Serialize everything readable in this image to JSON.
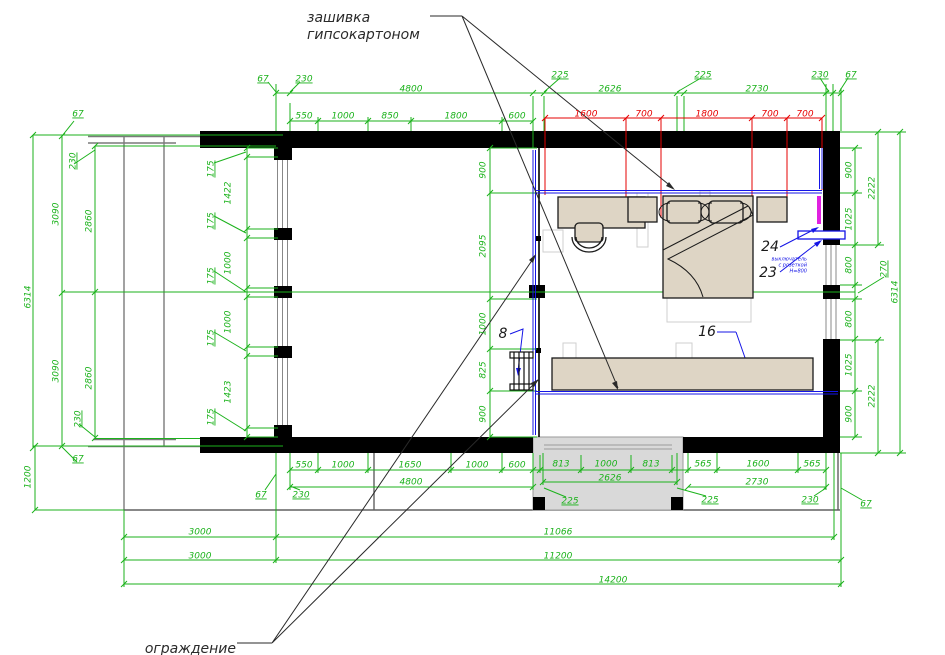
{
  "drawing": {
    "type": "floor-plan",
    "colors": {
      "dimension_green": "#1bb21b",
      "dimension_red": "#e60000",
      "annotation_blue": "#1414e6",
      "heater_magenta": "#e020e0",
      "wall_black": "#000000",
      "furniture_beige": "#ded5c5",
      "terrace_grey": "#d9d9d9"
    }
  },
  "texts": {
    "annotations": [
      {
        "t": "зашивка",
        "x": 307,
        "y": 18,
        "cls": "note"
      },
      {
        "t": "гипсокартоном",
        "x": 307,
        "y": 35,
        "cls": "note"
      },
      {
        "t": "ограждение",
        "x": 236,
        "y": 649,
        "cls": "note-end"
      },
      {
        "t": "выключатель",
        "x": 807,
        "y": 259,
        "cls": "bnote"
      },
      {
        "t": "с розеткой",
        "x": 807,
        "y": 265,
        "cls": "bnote"
      },
      {
        "t": "Н=800",
        "x": 807,
        "y": 271,
        "cls": "bnote"
      }
    ],
    "items": [
      {
        "t": "24",
        "x": 770,
        "y": 247
      },
      {
        "t": "23",
        "x": 768,
        "y": 273
      },
      {
        "t": "16",
        "x": 707,
        "y": 332
      },
      {
        "t": "8",
        "x": 503,
        "y": 334
      }
    ],
    "red": [
      {
        "t": "1600",
        "x": 586,
        "y": 114
      },
      {
        "t": "700",
        "x": 644,
        "y": 114
      },
      {
        "t": "1800",
        "x": 707,
        "y": 114
      },
      {
        "t": "700",
        "x": 770,
        "y": 114
      },
      {
        "t": "700",
        "x": 805,
        "y": 114
      }
    ],
    "green": [
      {
        "t": "67",
        "x": 263,
        "y": 79,
        "ul": 1
      },
      {
        "t": "230",
        "x": 304,
        "y": 79,
        "ul": 1
      },
      {
        "t": "4800",
        "x": 411,
        "y": 89
      },
      {
        "t": "550",
        "x": 304,
        "y": 116
      },
      {
        "t": "1000",
        "x": 343,
        "y": 116
      },
      {
        "t": "850",
        "x": 390,
        "y": 116
      },
      {
        "t": "1800",
        "x": 456,
        "y": 116
      },
      {
        "t": "600",
        "x": 517,
        "y": 116
      },
      {
        "t": "225",
        "x": 560,
        "y": 75,
        "ul": 1
      },
      {
        "t": "2626",
        "x": 610,
        "y": 89
      },
      {
        "t": "225",
        "x": 703,
        "y": 75,
        "ul": 1
      },
      {
        "t": "2730",
        "x": 757,
        "y": 89
      },
      {
        "t": "230",
        "x": 820,
        "y": 75,
        "ul": 1
      },
      {
        "t": "67",
        "x": 851,
        "y": 75,
        "ul": 1
      },
      {
        "t": "67",
        "x": 78,
        "y": 114,
        "ul": 1
      },
      {
        "t": "230",
        "x": 73,
        "y": 161,
        "r": -90,
        "ul": 1
      },
      {
        "t": "3090",
        "x": 56,
        "y": 214,
        "r": -90
      },
      {
        "t": "2860",
        "x": 89,
        "y": 221,
        "r": -90
      },
      {
        "t": "6314",
        "x": 28,
        "y": 297,
        "r": -90
      },
      {
        "t": "3090",
        "x": 56,
        "y": 371,
        "r": -90
      },
      {
        "t": "2860",
        "x": 89,
        "y": 378,
        "r": -90
      },
      {
        "t": "230",
        "x": 78,
        "y": 419,
        "r": -90,
        "ul": 1
      },
      {
        "t": "67",
        "x": 78,
        "y": 459,
        "ul": 1
      },
      {
        "t": "1200",
        "x": 28,
        "y": 477,
        "r": -90
      },
      {
        "t": "175",
        "x": 211,
        "y": 169,
        "r": -90,
        "ul": 1
      },
      {
        "t": "1422",
        "x": 228,
        "y": 193,
        "r": -90
      },
      {
        "t": "175",
        "x": 211,
        "y": 221,
        "r": -90,
        "ul": 1
      },
      {
        "t": "1000",
        "x": 228,
        "y": 263,
        "r": -90
      },
      {
        "t": "175",
        "x": 211,
        "y": 276,
        "r": -90,
        "ul": 1
      },
      {
        "t": "1000",
        "x": 228,
        "y": 322,
        "r": -90
      },
      {
        "t": "175",
        "x": 211,
        "y": 338,
        "r": -90,
        "ul": 1
      },
      {
        "t": "1423",
        "x": 228,
        "y": 392,
        "r": -90
      },
      {
        "t": "175",
        "x": 211,
        "y": 417,
        "r": -90,
        "ul": 1
      },
      {
        "t": "900",
        "x": 483,
        "y": 170,
        "r": -90
      },
      {
        "t": "2095",
        "x": 483,
        "y": 246,
        "r": -90
      },
      {
        "t": "1000",
        "x": 483,
        "y": 324,
        "r": -90
      },
      {
        "t": "825",
        "x": 483,
        "y": 370,
        "r": -90
      },
      {
        "t": "900",
        "x": 483,
        "y": 414,
        "r": -90
      },
      {
        "t": "900",
        "x": 849,
        "y": 170,
        "r": -90
      },
      {
        "t": "1025",
        "x": 849,
        "y": 219,
        "r": -90
      },
      {
        "t": "800",
        "x": 849,
        "y": 265,
        "r": -90
      },
      {
        "t": "270",
        "x": 884,
        "y": 269,
        "r": -90,
        "ul": 1
      },
      {
        "t": "800",
        "x": 849,
        "y": 319,
        "r": -90
      },
      {
        "t": "1025",
        "x": 849,
        "y": 365,
        "r": -90
      },
      {
        "t": "900",
        "x": 849,
        "y": 414,
        "r": -90
      },
      {
        "t": "2222",
        "x": 872,
        "y": 188,
        "r": -90
      },
      {
        "t": "2222",
        "x": 872,
        "y": 396,
        "r": -90
      },
      {
        "t": "6314",
        "x": 895,
        "y": 292,
        "r": -90
      },
      {
        "t": "550",
        "x": 304,
        "y": 465
      },
      {
        "t": "1000",
        "x": 343,
        "y": 465
      },
      {
        "t": "1650",
        "x": 410,
        "y": 465
      },
      {
        "t": "1000",
        "x": 477,
        "y": 465
      },
      {
        "t": "600",
        "x": 517,
        "y": 465
      },
      {
        "t": "813",
        "x": 561,
        "y": 464
      },
      {
        "t": "1000",
        "x": 606,
        "y": 464
      },
      {
        "t": "813",
        "x": 651,
        "y": 464
      },
      {
        "t": "565",
        "x": 703,
        "y": 464
      },
      {
        "t": "1600",
        "x": 758,
        "y": 464
      },
      {
        "t": "565",
        "x": 812,
        "y": 464
      },
      {
        "t": "4800",
        "x": 411,
        "y": 482
      },
      {
        "t": "2626",
        "x": 610,
        "y": 478
      },
      {
        "t": "2730",
        "x": 757,
        "y": 482
      },
      {
        "t": "67",
        "x": 261,
        "y": 495,
        "ul": 1
      },
      {
        "t": "230",
        "x": 301,
        "y": 495,
        "ul": 1
      },
      {
        "t": "225",
        "x": 570,
        "y": 501,
        "ul": 1
      },
      {
        "t": "225",
        "x": 710,
        "y": 500,
        "ul": 1
      },
      {
        "t": "230",
        "x": 810,
        "y": 500,
        "ul": 1
      },
      {
        "t": "67",
        "x": 866,
        "y": 504,
        "ul": 1
      },
      {
        "t": "3000",
        "x": 200,
        "y": 532
      },
      {
        "t": "11066",
        "x": 558,
        "y": 532
      },
      {
        "t": "3000",
        "x": 200,
        "y": 556
      },
      {
        "t": "11200",
        "x": 558,
        "y": 556
      },
      {
        "t": "14200",
        "x": 613,
        "y": 580
      }
    ]
  }
}
